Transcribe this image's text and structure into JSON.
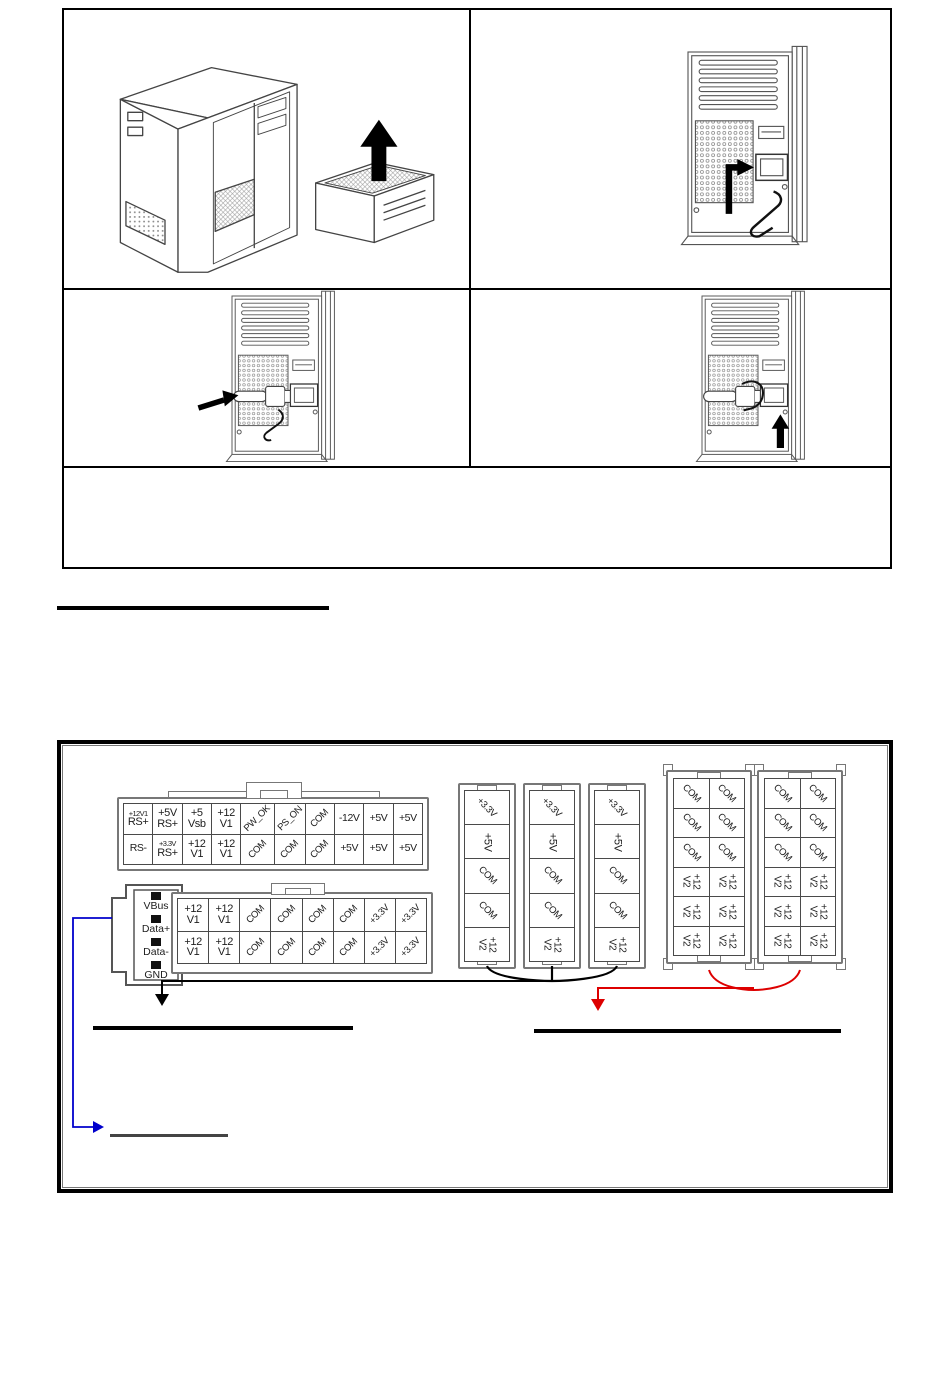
{
  "page": {
    "background": "#ffffff"
  },
  "steps_table": {
    "cells": [
      {
        "name": "psu-removal-illustration",
        "variant": "case-psu-lift"
      },
      {
        "name": "rear-inlet-illustration",
        "variant": "rear-inlet-clip"
      },
      {
        "name": "cord-insert-illustration",
        "variant": "rear-cord-insert"
      },
      {
        "name": "clip-secure-illustration",
        "variant": "rear-clip-secure"
      },
      {
        "name": "note-cell",
        "variant": "empty"
      }
    ]
  },
  "pinout_panel": {
    "atx24": {
      "rows": [
        [
          {
            "text": [
              "+12V1",
              "RS+"
            ],
            "style": "stack-small"
          },
          {
            "text": [
              "+5V",
              "RS+"
            ],
            "style": "stack"
          },
          {
            "text": [
              "+5",
              "Vsb"
            ],
            "style": "stack"
          },
          {
            "text": [
              "+12",
              "V1"
            ],
            "style": "stack"
          },
          {
            "text": [
              "PW_OK"
            ],
            "style": "diag"
          },
          {
            "text": [
              "PS_ON"
            ],
            "style": "diag"
          },
          {
            "text": [
              "COM"
            ],
            "style": "diag"
          },
          {
            "text": [
              "-12V"
            ],
            "style": "plain"
          },
          {
            "text": [
              "+5V"
            ],
            "style": "plain"
          },
          {
            "text": [
              "+5V"
            ],
            "style": "plain"
          }
        ],
        [
          {
            "text": [
              "RS-"
            ],
            "style": "plain"
          },
          {
            "text": [
              "+3.3V",
              "RS+"
            ],
            "style": "stack-small"
          },
          {
            "text": [
              "+12",
              "V1"
            ],
            "style": "stack"
          },
          {
            "text": [
              "+12",
              "V1"
            ],
            "style": "stack"
          },
          {
            "text": [
              "COM"
            ],
            "style": "diag"
          },
          {
            "text": [
              "COM"
            ],
            "style": "diag"
          },
          {
            "text": [
              "COM"
            ],
            "style": "diag"
          },
          {
            "text": [
              "+5V"
            ],
            "style": "plain"
          },
          {
            "text": [
              "+5V"
            ],
            "style": "plain"
          },
          {
            "text": [
              "+5V"
            ],
            "style": "plain"
          }
        ]
      ]
    },
    "usb": {
      "pins": [
        "VBus",
        "Data+",
        "Data-",
        "GND"
      ]
    },
    "eps": {
      "rows": [
        [
          {
            "text": [
              "+12",
              "V1"
            ],
            "style": "stack"
          },
          {
            "text": [
              "+12",
              "V1"
            ],
            "style": "stack"
          },
          {
            "text": [
              "COM"
            ],
            "style": "diag"
          },
          {
            "text": [
              "COM"
            ],
            "style": "diag"
          },
          {
            "text": [
              "COM"
            ],
            "style": "diag"
          },
          {
            "text": [
              "COM"
            ],
            "style": "diag"
          },
          {
            "text": [
              "+3.3V"
            ],
            "style": "diag"
          },
          {
            "text": [
              "+3.3V"
            ],
            "style": "diag"
          }
        ],
        [
          {
            "text": [
              "+12",
              "V1"
            ],
            "style": "stack"
          },
          {
            "text": [
              "+12",
              "V1"
            ],
            "style": "stack"
          },
          {
            "text": [
              "COM"
            ],
            "style": "diag"
          },
          {
            "text": [
              "COM"
            ],
            "style": "diag"
          },
          {
            "text": [
              "COM"
            ],
            "style": "diag"
          },
          {
            "text": [
              "COM"
            ],
            "style": "diag"
          },
          {
            "text": [
              "+3.3V"
            ],
            "style": "diag"
          },
          {
            "text": [
              "+3.3V"
            ],
            "style": "diag"
          }
        ]
      ]
    },
    "peripheral": {
      "count": 3,
      "pins": [
        {
          "text": [
            "+3.3V"
          ],
          "style": "diag45"
        },
        {
          "text": [
            "+5V"
          ],
          "style": "vert"
        },
        {
          "text": [
            "COM"
          ],
          "style": "diag45"
        },
        {
          "text": [
            "COM"
          ],
          "style": "diag45"
        },
        {
          "text": [
            "+12",
            "V2"
          ],
          "style": "vert-stack"
        }
      ]
    },
    "pcie": {
      "count": 2,
      "columns": 2,
      "column_pins": [
        {
          "text": [
            "COM"
          ],
          "style": "diag45"
        },
        {
          "text": [
            "COM"
          ],
          "style": "diag45"
        },
        {
          "text": [
            "COM"
          ],
          "style": "diag45"
        },
        {
          "text": [
            "+12",
            "V2"
          ],
          "style": "vert-stack"
        },
        {
          "text": [
            "+12",
            "V2"
          ],
          "style": "vert-stack"
        },
        {
          "text": [
            "+12",
            "V2"
          ],
          "style": "vert-stack"
        }
      ]
    },
    "accent_colors": {
      "wire_black": "#000000",
      "wire_red": "#dd0000",
      "callout_blue": "#0000cc",
      "line_gray": "#444444"
    }
  }
}
